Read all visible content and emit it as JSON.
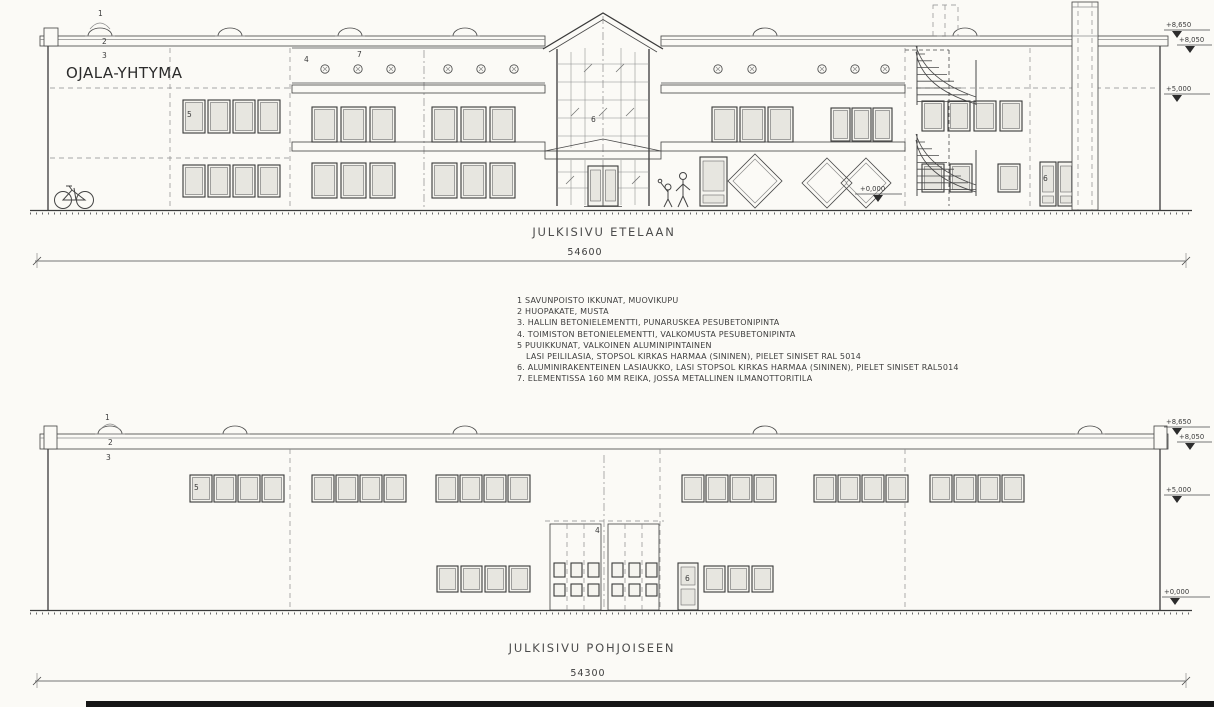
{
  "sheet": {
    "company": "OJALA-YHTYMA",
    "south": {
      "caption": "JULKISIVU ETELAAN",
      "dimension": "54600"
    },
    "north": {
      "caption": "JULKISIVU POHJOISEEN",
      "dimension": "54300"
    },
    "levels": {
      "parapet": "+8,650",
      "fascia": "+8,050",
      "mid": "+5,000",
      "ground": "+0,000"
    },
    "callouts": {
      "n1": "1",
      "n2": "2",
      "n3": "3",
      "n4": "4",
      "n5": "5",
      "n6": "6",
      "n7": "7"
    },
    "legend": {
      "lines": [
        "1  SAVUNPOISTO IKKUNAT, MUOVIKUPU",
        "2  HUOPAKATE, MUSTA",
        "3. HALLIN BETONIELEMENTTI, PUNARUSKEA PESUBETONIPINTA",
        "4. TOIMISTON BETONIELEMENTTI, VALKOMUSTA PESUBETONIPINTA",
        "5  PUUIKKUNAT, VALKOINEN ALUMINIPINTAINEN",
        "LASI PEILILASIA, STOPSOL KIRKAS HARMAA (SININEN), PIELET SINISET RAL 5014",
        "6. ALUMINIRAKENTEINEN LASIAUKKO, LASI STOPSOL KIRKAS HARMAA (SININEN), PIELET SINISET RAL5014",
        "7. ELEMENTISSA 160 MM REIKA, JOSSA METALLINEN ILMANOTTORITILA"
      ]
    }
  }
}
